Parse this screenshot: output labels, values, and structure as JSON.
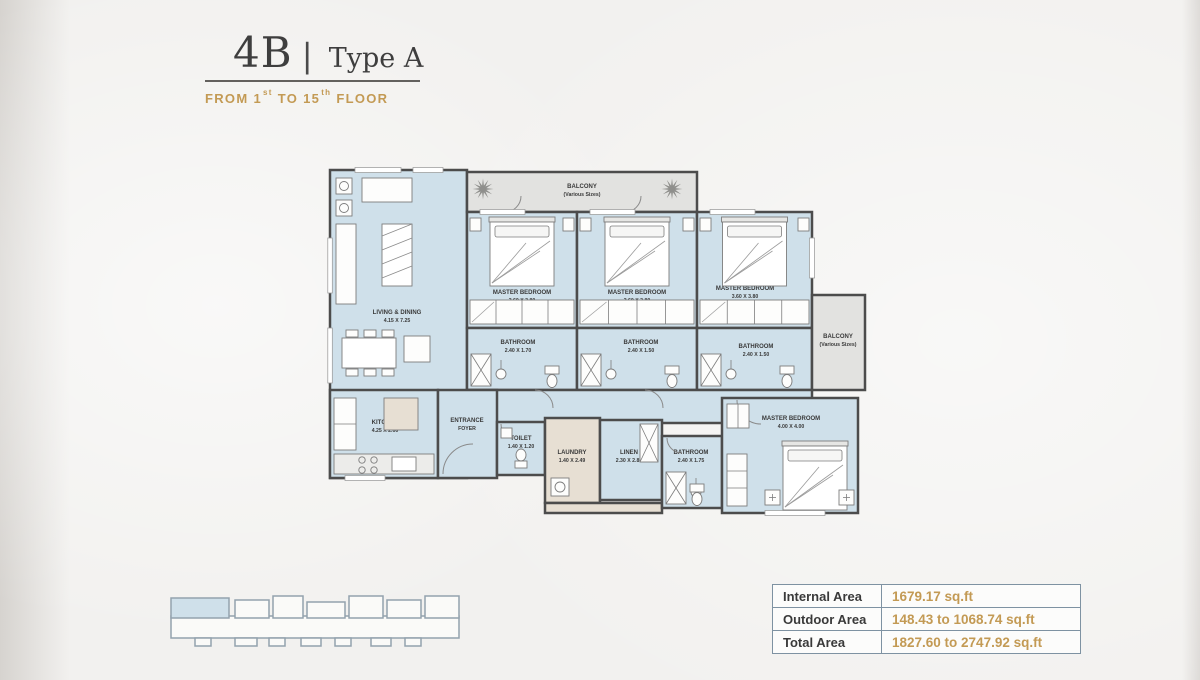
{
  "header": {
    "unit_code": "4B",
    "separator": "|",
    "unit_type": "Type A",
    "floor_note": {
      "from": "FROM",
      "first": "1",
      "first_sup": "st",
      "to": "TO",
      "last": "15",
      "last_sup": "th",
      "floor": "FLOOR"
    }
  },
  "floor_plan": {
    "rooms": [
      {
        "id": "living-dining",
        "label": "LIVING & DINING",
        "dims": "4.15 X 7.25",
        "x": 5,
        "y": 12,
        "w": 137,
        "h": 308,
        "fill": "blue",
        "lx": 72,
        "ly": 156,
        "fx": "living"
      },
      {
        "id": "balcony-top",
        "label": "BALCONY",
        "dims": "(Various Sizes)",
        "x": 142,
        "y": 14,
        "w": 230,
        "h": 40,
        "fill": "gray",
        "lx": 257,
        "ly": 30
      },
      {
        "id": "bedroom-1",
        "label": "MASTER BEDROOM",
        "dims": "3.60 X 3.80",
        "x": 142,
        "y": 54,
        "w": 110,
        "h": 116,
        "fill": "blue",
        "lx": 197,
        "ly": 136,
        "fx": "bedv"
      },
      {
        "id": "bedroom-2",
        "label": "MASTER BEDROOM",
        "dims": "3.60 X 3.80",
        "x": 252,
        "y": 54,
        "w": 120,
        "h": 116,
        "fill": "blue",
        "lx": 312,
        "ly": 136,
        "fx": "bedv"
      },
      {
        "id": "bedroom-3",
        "label": "MASTER BEDROOM",
        "dims": "3.60 X 3.80",
        "x": 372,
        "y": 54,
        "w": 115,
        "h": 116,
        "fill": "blue",
        "lx": 420,
        "ly": 132,
        "fx": "bedv"
      },
      {
        "id": "bathroom-1",
        "label": "BATHROOM",
        "dims": "2.40 X 1.70",
        "x": 142,
        "y": 170,
        "w": 110,
        "h": 62,
        "fill": "blue",
        "lx": 193,
        "ly": 186,
        "fx": "bath"
      },
      {
        "id": "bathroom-2",
        "label": "BATHROOM",
        "dims": "2.40 X 1.50",
        "x": 252,
        "y": 170,
        "w": 120,
        "h": 62,
        "fill": "blue",
        "lx": 316,
        "ly": 186,
        "fx": "bath"
      },
      {
        "id": "bathroom-3",
        "label": "BATHROOM",
        "dims": "2.40 X 1.50",
        "x": 372,
        "y": 170,
        "w": 115,
        "h": 62,
        "fill": "blue",
        "lx": 431,
        "ly": 190,
        "fx": "bath"
      },
      {
        "id": "balcony-right",
        "label": "BALCONY",
        "dims": "(Various Sizes)",
        "x": 487,
        "y": 137,
        "w": 53,
        "h": 95,
        "fill": "gray",
        "lx": 513,
        "ly": 180
      },
      {
        "id": "hallway",
        "label": "",
        "dims": "",
        "x": 142,
        "y": 232,
        "w": 345,
        "h": 33,
        "fill": "blue"
      },
      {
        "id": "kitchen",
        "label": "KITCHEN",
        "dims": "4.25 X 2.60",
        "x": 5,
        "y": 232,
        "w": 108,
        "h": 88,
        "fill": "blue",
        "lx": 60,
        "ly": 266,
        "fx": "kitchen"
      },
      {
        "id": "entrance-foyer",
        "label": "ENTRANCE",
        "dims": "FOYER",
        "x": 113,
        "y": 232,
        "w": 59,
        "h": 88,
        "fill": "blue",
        "lx": 142,
        "ly": 264
      },
      {
        "id": "toilet",
        "label": "TOILET",
        "dims": "1.40 X 1.20",
        "x": 172,
        "y": 264,
        "w": 48,
        "h": 53,
        "fill": "blue",
        "lx": 196,
        "ly": 282,
        "fx": "wc"
      },
      {
        "id": "laundry",
        "label": "LAUNDRY",
        "dims": "1.40 X 2.49",
        "x": 220,
        "y": 260,
        "w": 55,
        "h": 85,
        "fill": "beige",
        "lx": 247,
        "ly": 296,
        "fx": "laundry"
      },
      {
        "id": "linen",
        "label": "LINEN",
        "dims": "2.30 X 2.89",
        "x": 275,
        "y": 262,
        "w": 62,
        "h": 80,
        "fill": "blue",
        "lx": 304,
        "ly": 296,
        "fx": "linen"
      },
      {
        "id": "service-hall",
        "label": "",
        "dims": "",
        "x": 220,
        "y": 345,
        "w": 117,
        "h": 10,
        "fill": "beige"
      },
      {
        "id": "bathroom-4",
        "label": "BATHROOM",
        "dims": "2.40 X 1.75",
        "x": 337,
        "y": 278,
        "w": 60,
        "h": 72,
        "fill": "blue",
        "lx": 366,
        "ly": 296,
        "fx": "bath"
      },
      {
        "id": "bedroom-4",
        "label": "MASTER BEDROOM",
        "dims": "4.00 X 4.00",
        "x": 397,
        "y": 240,
        "w": 136,
        "h": 115,
        "fill": "blue",
        "lx": 466,
        "ly": 262,
        "fx": "bed4"
      }
    ],
    "plants": [
      {
        "x": 158,
        "y": 31
      },
      {
        "x": 347,
        "y": 31
      }
    ]
  },
  "area_table": {
    "rows": [
      {
        "label": "Internal Area",
        "value": "1679.17 sq.ft"
      },
      {
        "label": "Outdoor Area",
        "value": "148.43 to 1068.74 sq.ft"
      },
      {
        "label": "Total Area",
        "value": "1827.60 to 2747.92 sq.ft"
      }
    ]
  },
  "colors": {
    "accent_gold": "#c39a54",
    "room_fill": "#cfe0ea",
    "balcony_fill": "#e2e2e0",
    "service_fill": "#e7dfd3",
    "wall": "#4c4c4c",
    "table_border": "#7e92a2"
  }
}
